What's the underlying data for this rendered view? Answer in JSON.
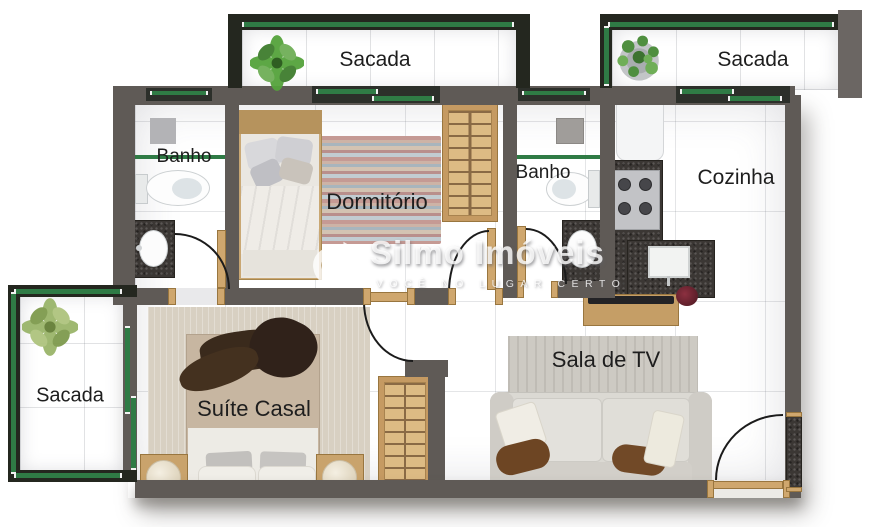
{
  "watermark": {
    "brand": "Silmo Imóveis",
    "tagline": "VOCÊ NO LUGAR CERTO"
  },
  "rooms": {
    "sacada_top_left": {
      "label": "Sacada"
    },
    "sacada_top_right": {
      "label": "Sacada"
    },
    "sacada_left": {
      "label": "Sacada"
    },
    "banho_1": {
      "label": "Banho"
    },
    "dormitorio": {
      "label": "Dormitório"
    },
    "banho_2": {
      "label": "Banho"
    },
    "cozinha": {
      "label": "Cozinha"
    },
    "suite_casal": {
      "label": "Suíte Casal"
    },
    "sala_de_tv": {
      "label": "Sala de TV"
    }
  },
  "colors": {
    "wall": "#5f5a56",
    "balcony_wall": "#24271f",
    "railing_green": "#2f7b45",
    "floor": "#e9e9eb",
    "granite": "#3b3734",
    "wood": "#cfa76e",
    "label_text": "#1e1e1e"
  }
}
